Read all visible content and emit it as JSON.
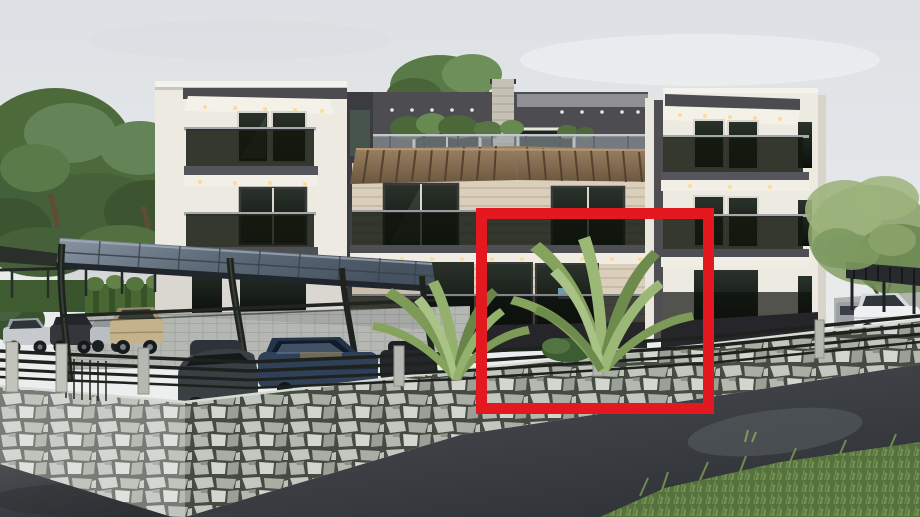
{
  "scene": {
    "type": "3d-architectural-exterior-render",
    "subject": "Modern three-storey apartment building with glass balconies, wooden pergolas, rooftop terrace, curved carport with parked cars, natural stone retaining wall, fern shrubs and asphalt road",
    "annotation_note": "Red outline rectangle marks the highlighted ground-floor apartment unit",
    "visible_cars": 9
  },
  "annotation": {
    "shape": "rectangle",
    "color": "#e4191f",
    "x": 476,
    "y": 208,
    "width": 238,
    "height": 206,
    "stroke_px": 11
  },
  "palette": {
    "sky_top": "#dde1e5",
    "sky_bottom": "#f2f3f3",
    "facade_white": "#edeae2",
    "facade_beige": "#d9cfba",
    "penthouse_dark": "#4c4c51",
    "balcony_glass": "#10150e",
    "pergola_wood": "#8a7156",
    "stone_wall": "#b6bab1",
    "asphalt": "#3f4347",
    "vegetation": "#557139",
    "carport_canopy": "#5c6875",
    "highlight_red": "#e4191f"
  }
}
